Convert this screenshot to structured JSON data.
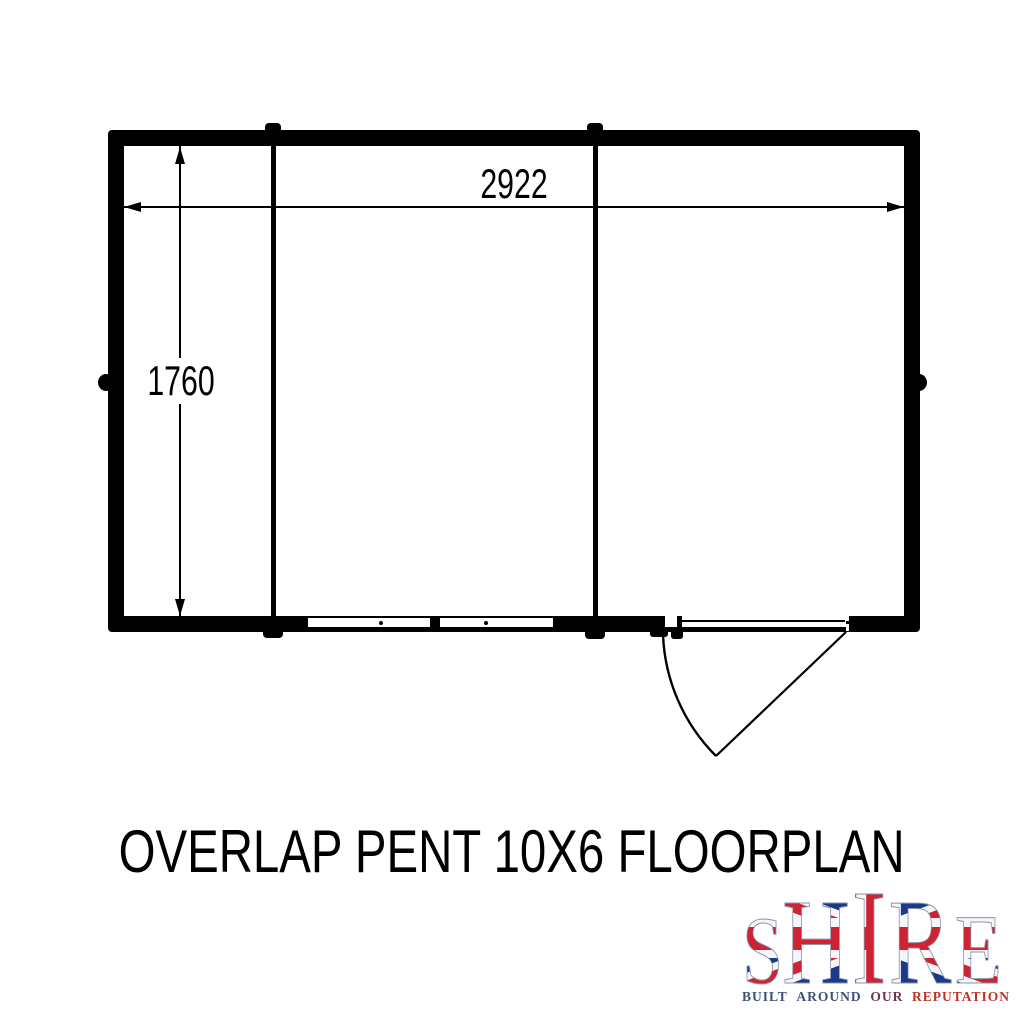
{
  "floorplan": {
    "title": "OVERLAP PENT 10X6 FLOORPLAN",
    "dimensions": {
      "width_mm": "2922",
      "height_mm": "1760"
    },
    "line_color": "#000000",
    "background_color": "#ffffff"
  },
  "logo": {
    "brand": "SHIRE",
    "brand_letters": [
      "S",
      "H",
      "I",
      "R",
      "E"
    ],
    "tagline": "BUILT AROUND OUR REPUTATION",
    "tagline_parts": [
      {
        "text": "BUILT",
        "color": "#3d5077"
      },
      {
        "text": "AROUND",
        "color": "#3d5077"
      },
      {
        "text": "OUR",
        "color": "#6b3552"
      },
      {
        "text": "REPUTATION",
        "color": "#c13327"
      }
    ],
    "flag_colors": {
      "navy": "#1b3a8c",
      "red": "#cf2233",
      "white": "#f4f6fa"
    }
  }
}
